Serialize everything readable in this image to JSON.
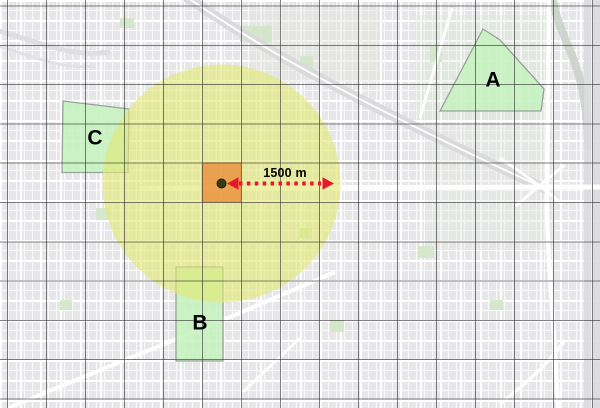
{
  "view": {
    "width": 600,
    "height": 408,
    "type": "map-canvas"
  },
  "buffer": {
    "radius_label": "1500 m",
    "center_x": 221.5,
    "center_y": 183.5,
    "radius_px": 119
  },
  "zones": [
    {
      "label": "A"
    },
    {
      "label": "B"
    },
    {
      "label": "C"
    }
  ],
  "colors": {
    "buffer_fill": "#e3e873",
    "impact_cell_fill": "#ea8f3c",
    "center_point_fill": "#333b0f",
    "zone_fill": "#c4f2bd",
    "zone_stroke": "#97a29a",
    "arrow_red": "#e8192c",
    "label_color": "#000000",
    "grid_line": "#323232",
    "basemap_gray": "#e7e7e9"
  }
}
